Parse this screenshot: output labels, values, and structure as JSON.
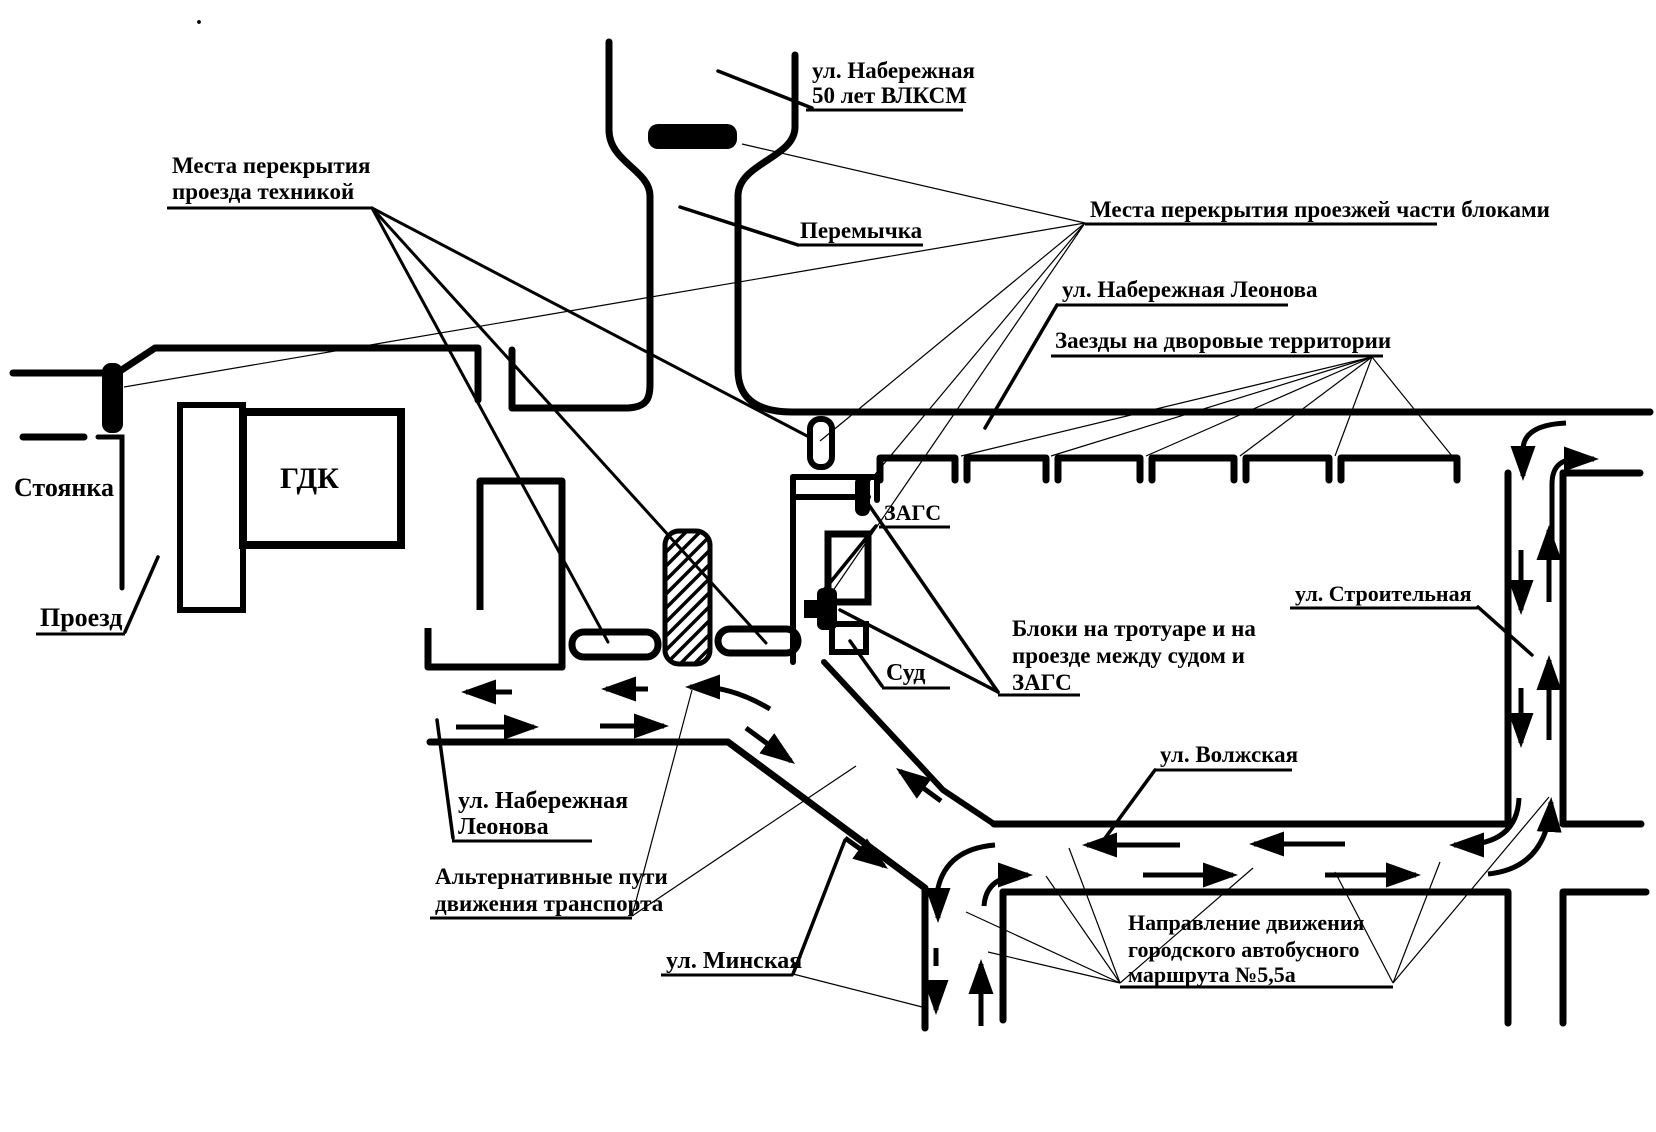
{
  "diagram": {
    "title_hint": "Схема перекрытия движения (traffic closure scheme)",
    "background_color": "#ffffff",
    "ink_color": "#000000",
    "labels": {
      "stray_dot": ".",
      "ul_naberezhnaya_vlksm_1": "ул. Набережная",
      "ul_naberezhnaya_vlksm_2": "50 лет ВЛКСМ",
      "peremychka": "Перемычка",
      "mesta_tekhnikoy_1": "Места перекрытия",
      "mesta_tekhnikoy_2": "проезда техникой",
      "mesta_blokami": "Места перекрытия проезжей части блоками",
      "ul_naberezhnaya_leonova_top": "ул. Набережная Леонова",
      "zaezdy": "Заезды на дворовые территории",
      "gdk": "ГДК",
      "stoyanka": "Стоянка",
      "proezd": "Проезд",
      "zags_small": "ЗАГС",
      "sud_small": "Суд",
      "ul_stroitelnaya": "ул. Строительная",
      "bloki_1": "Блоки на тротуаре и на",
      "bloki_2": "проезде между судом и",
      "bloki_3": "ЗАГС",
      "ul_volzhskaya": "ул. Волжская",
      "ul_leonova_left_1": "ул. Набережная",
      "ul_leonova_left_2": "Леонова",
      "alt_puti_1": "Альтернативные пути",
      "alt_puti_2": "движения транспорта",
      "ul_minskaya": "ул. Минская",
      "bus_route_1": "Направление движения",
      "bus_route_2": "городского автобусного",
      "bus_route_3": "маршрута №5,5а"
    }
  }
}
